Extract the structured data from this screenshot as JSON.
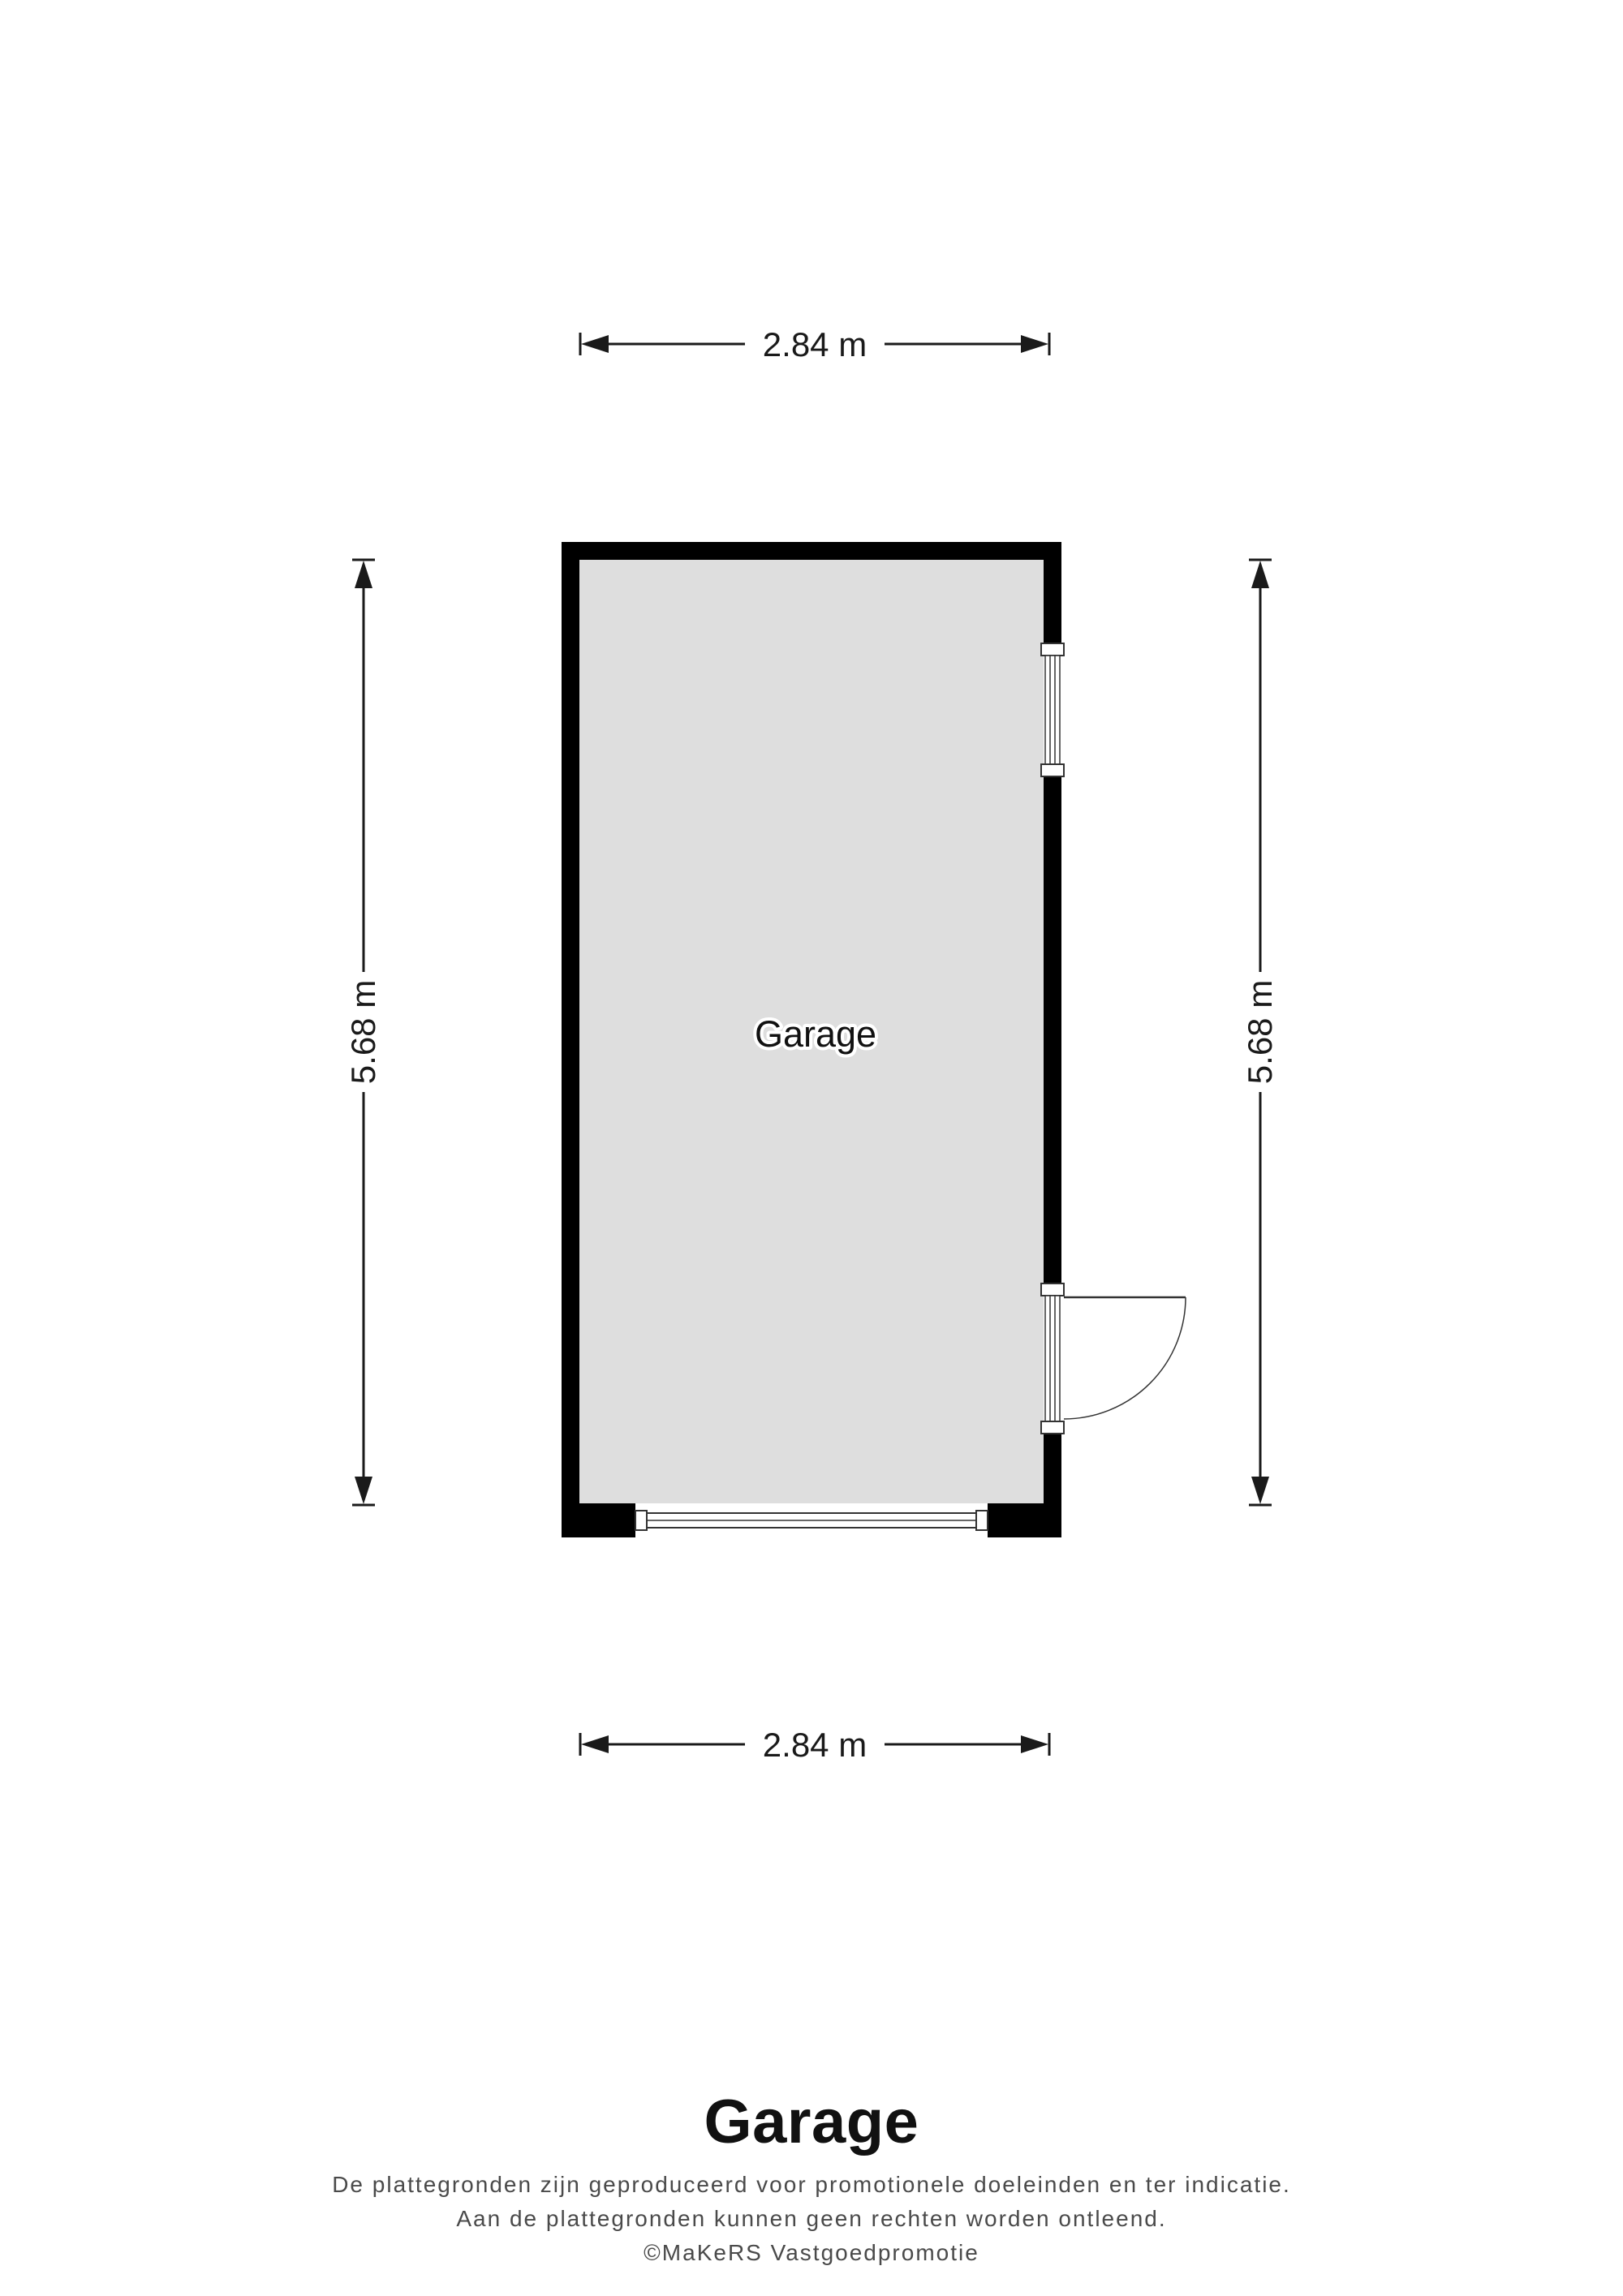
{
  "plan": {
    "room_label": "Garage",
    "dimensions": {
      "top": "2.84 m",
      "bottom": "2.84 m",
      "left": "5.68 m",
      "right": "5.68 m"
    },
    "colors": {
      "wall": "#000000",
      "floor": "#dedede",
      "dimension_line": "#1a1a1a",
      "symbol_stroke": "#333333",
      "disclaimer_text": "#4a4a4a"
    }
  },
  "footer": {
    "title": "Garage",
    "disclaimer_line1": "De plattegronden zijn geproduceerd voor promotionele doeleinden en ter indicatie.",
    "disclaimer_line2": "Aan de plattegronden kunnen geen rechten worden ontleend.",
    "disclaimer_line3": "©MaKeRS Vastgoedpromotie"
  }
}
